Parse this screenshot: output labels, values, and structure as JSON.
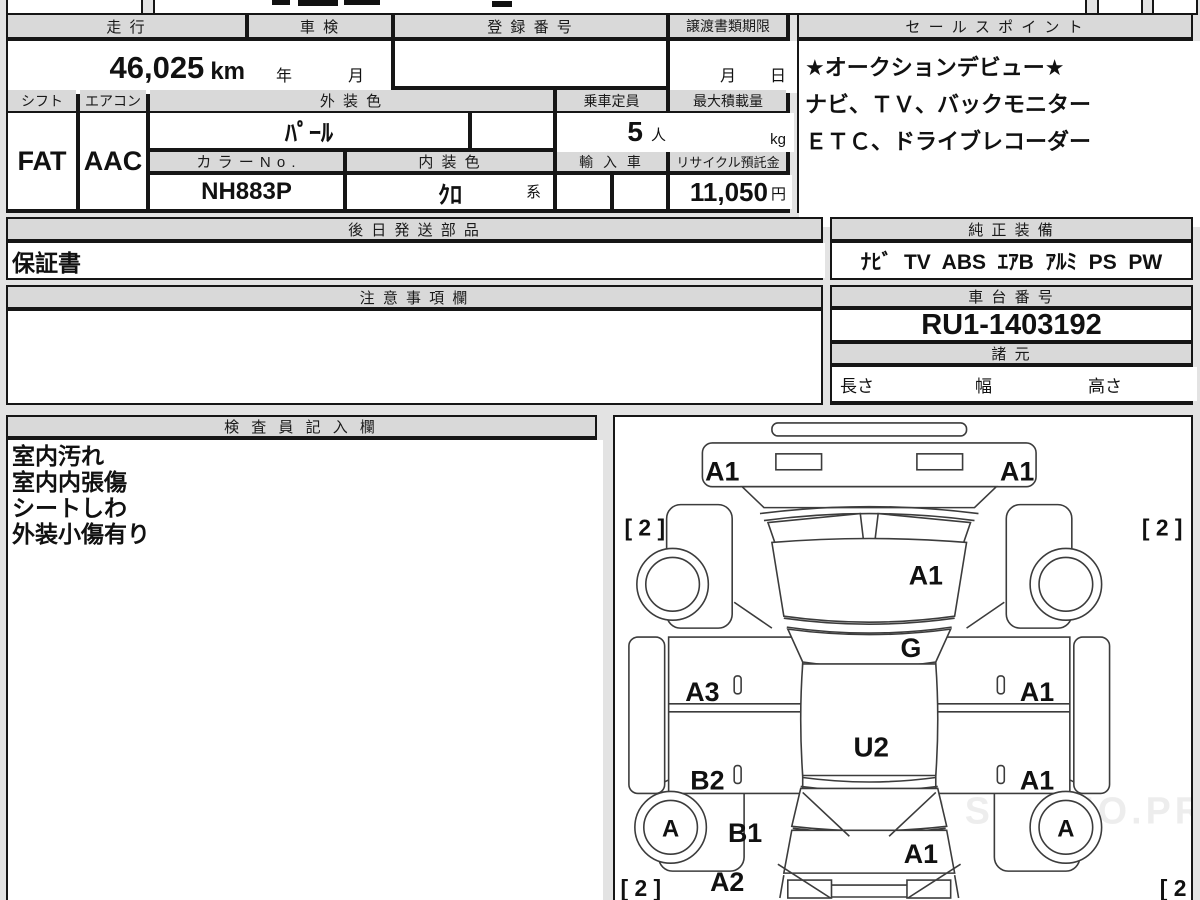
{
  "page": {
    "watermark": "WEB STUDIO.PRO"
  },
  "main_table": {
    "headers": {
      "mileage": "走 行",
      "inspection": "車 検",
      "registration_no": "登 録 番 号",
      "transfer_deadline": "譲渡書類期限",
      "shift": "シフト",
      "aircon": "エアコン",
      "exterior_color": "外 装 色",
      "capacity": "乗車定員",
      "max_load": "最大積載量",
      "color_no": "カ ラ ー N o .",
      "interior_color": "内 装 色",
      "import_car": "輸 入 車",
      "recycle_deposit": "リサイクル預託金"
    },
    "values": {
      "mileage": "46,025",
      "mileage_unit": "km",
      "inspection_year": "年",
      "inspection_month": "月",
      "deadline_month": "月",
      "deadline_day": "日",
      "shift": "FAT",
      "aircon": "AAC",
      "exterior_color": "ﾊﾟｰﾙ",
      "capacity": "5",
      "capacity_unit": "人",
      "max_load_unit": "kg",
      "color_no": "NH883P",
      "interior_color": "ｸﾛ",
      "interior_color_suffix": "系",
      "recycle_deposit": "11,050",
      "recycle_deposit_unit": "円"
    }
  },
  "sales_points": {
    "title": "セ ー ル ス ポ イ ン ト",
    "lines": [
      "★オークションデビュー★",
      "ナビ、ＴＶ、バックモニター",
      "ＥＴＣ、ドライブレコーダー"
    ]
  },
  "later_parts": {
    "title": "後 日 発 送 部 品",
    "value": "保証書"
  },
  "notes": {
    "title": "注 意 事 項 欄",
    "value": ""
  },
  "equipment": {
    "title": "純 正 装 備",
    "value": "ﾅﾋﾞ  TV  ABS  ｴｱB  ｱﾙﾐ  PS  PW"
  },
  "chassis": {
    "title": "車 台 番 号",
    "value": "RU1-1403192"
  },
  "specs": {
    "title": "諸 元",
    "length_label": "長さ",
    "width_label": "幅",
    "height_label": "高さ"
  },
  "inspector": {
    "title": "検 査 員 記 入 欄",
    "lines": [
      "室内汚れ",
      "室内内張傷",
      "シートしわ",
      "外装小傷有り"
    ]
  },
  "diagram": {
    "front_bumper_left": "A1",
    "front_bumper_right": "A1",
    "front_left_tire_grade": "[ 2 ]",
    "front_right_tire_grade": "[ 2 ]",
    "hood": "A1",
    "windshield": "G",
    "left_front_door": "A3",
    "right_front_door": "A1",
    "roof": "U2",
    "left_rear_door": "B2",
    "right_rear_door": "A1",
    "left_quarter": "B1",
    "left_rear_corner": "A2",
    "tailgate": "A1",
    "rear_left_wheel": "A",
    "rear_right_wheel": "A",
    "rear_left_tire_grade": "[ 2 ]",
    "rear_right_tire_grade": "[ 2 ]"
  }
}
